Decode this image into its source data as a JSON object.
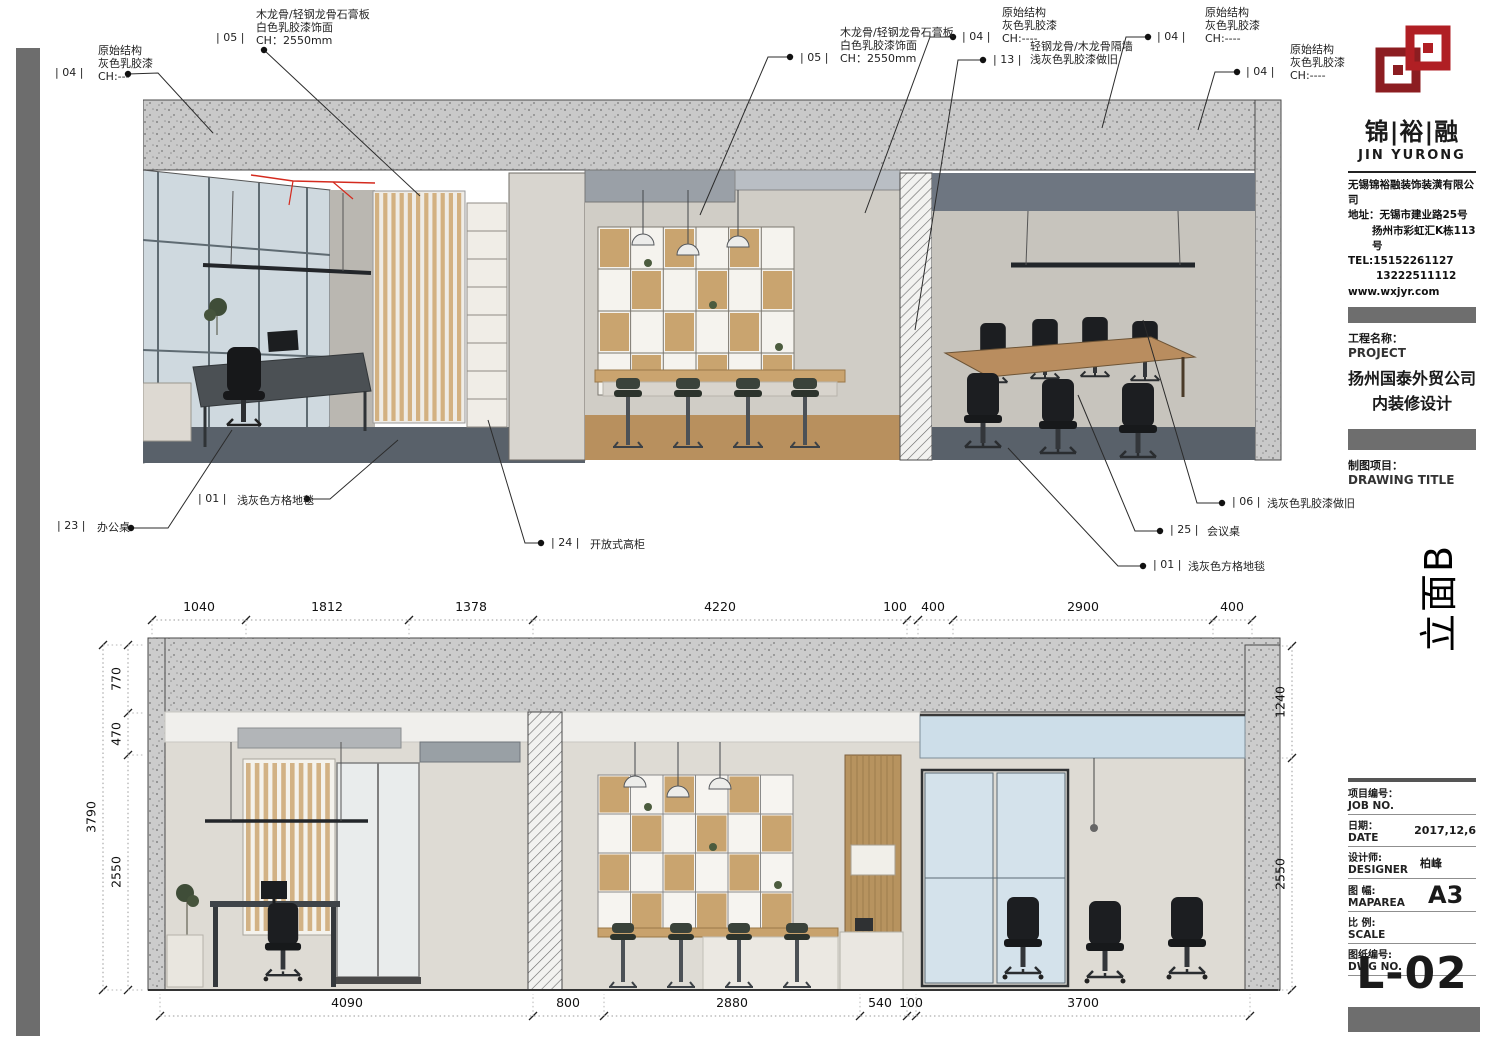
{
  "sidebar": {
    "brand": {
      "cn": "锦|裕|融",
      "en": "JIN YURONG",
      "company": "无锡锦裕融装饰装潢有限公司",
      "addr1": "地址：无锡市建业路25号",
      "addr2": "扬州市彩虹汇K栋113号",
      "tel1": "TEL:15152261127",
      "tel2": "13222511112",
      "web": "www.wxjyr.com",
      "logo_color": "#b01f24"
    },
    "project_label_cn": "工程名称：",
    "project_label_en": "PROJECT",
    "project_name1": "扬州国泰外贸公司",
    "project_name2": "内装修设计",
    "drawing_title_cn": "制图项目：",
    "drawing_title_en": "DRAWING TITLE",
    "elevation_tag": "立面B",
    "fields": [
      {
        "cn": "项目编号：",
        "en": "JOB NO.",
        "value": ""
      },
      {
        "cn": "日期：",
        "en": "DATE",
        "value": "2017,12,6"
      },
      {
        "cn": "设计师:",
        "en": "DESIGNER",
        "value": "柏峰"
      },
      {
        "cn": "图 幅:",
        "en": "MAPAREA",
        "value": "A3",
        "big": true
      },
      {
        "cn": "比 例:",
        "en": "SCALE",
        "value": ""
      },
      {
        "cn": "图纸编号:",
        "en": "DWG NO.",
        "value": ""
      }
    ],
    "dwg_no": "L-02"
  },
  "annotations": [
    {
      "code": "| 04 |",
      "lines": [
        "原始结构",
        "灰色乳胶漆",
        "CH:---"
      ],
      "code_pos": [
        55,
        66
      ],
      "text_pos": [
        98,
        44
      ],
      "leader": [
        [
          128,
          74
        ],
        [
          158,
          73
        ],
        [
          213,
          133
        ]
      ]
    },
    {
      "code": "| 05 |",
      "lines": [
        "木龙骨/轻钢龙骨石膏板",
        "白色乳胶漆饰面",
        "CH：2550mm"
      ],
      "code_pos": [
        216,
        31
      ],
      "text_pos": [
        256,
        8
      ],
      "leader": [
        [
          264,
          50
        ],
        [
          420,
          196
        ]
      ]
    },
    {
      "code": "| 05 |",
      "lines": [
        "木龙骨/轻钢龙骨石膏板",
        "白色乳胶漆饰面",
        "CH：2550mm"
      ],
      "code_pos": [
        800,
        51
      ],
      "text_pos": [
        840,
        26
      ],
      "leader": [
        [
          790,
          57
        ],
        [
          768,
          57
        ],
        [
          700,
          215
        ]
      ]
    },
    {
      "code": "| 04 |",
      "lines": [
        "原始结构",
        "灰色乳胶漆",
        "CH:----"
      ],
      "code_pos": [
        962,
        30
      ],
      "text_pos": [
        1002,
        6
      ],
      "leader": [
        [
          953,
          37
        ],
        [
          930,
          37
        ],
        [
          865,
          213
        ]
      ]
    },
    {
      "code": "| 13 |",
      "lines": [
        "轻钢龙骨/木龙骨隔墙",
        "浅灰色乳胶漆做旧"
      ],
      "code_pos": [
        993,
        53
      ],
      "text_pos": [
        1030,
        40
      ],
      "leader": [
        [
          983,
          60
        ],
        [
          958,
          60
        ],
        [
          915,
          330
        ]
      ]
    },
    {
      "code": "| 04 |",
      "lines": [
        "原始结构",
        "灰色乳胶漆",
        "CH:----"
      ],
      "code_pos": [
        1157,
        30
      ],
      "text_pos": [
        1205,
        6
      ],
      "leader": [
        [
          1148,
          37
        ],
        [
          1126,
          37
        ],
        [
          1102,
          128
        ]
      ]
    },
    {
      "code": "| 04 |",
      "lines": [
        "原始结构",
        "灰色乳胶漆",
        "CH:----"
      ],
      "code_pos": [
        1246,
        65
      ],
      "text_pos": [
        1290,
        43
      ],
      "leader": [
        [
          1237,
          72
        ],
        [
          1215,
          72
        ],
        [
          1198,
          130
        ]
      ]
    }
  ],
  "callouts": [
    {
      "code": "| 23 |",
      "text": "办公桌",
      "code_pos": [
        57,
        519
      ],
      "text_pos": [
        97,
        519
      ],
      "leader": [
        [
          131,
          528
        ],
        [
          168,
          528
        ],
        [
          232,
          430
        ]
      ]
    },
    {
      "code": "| 01 |",
      "text": "浅灰色方格地毯",
      "code_pos": [
        198,
        492
      ],
      "text_pos": [
        237,
        492
      ],
      "leader": [
        [
          307,
          499
        ],
        [
          330,
          499
        ],
        [
          398,
          440
        ]
      ]
    },
    {
      "code": "| 24 |",
      "text": "开放式高柜",
      "code_pos": [
        551,
        536
      ],
      "text_pos": [
        590,
        536
      ],
      "leader": [
        [
          541,
          543
        ],
        [
          525,
          543
        ],
        [
          488,
          420
        ]
      ]
    },
    {
      "code": "| 06 |",
      "text": "浅灰色乳胶漆做旧",
      "code_pos": [
        1232,
        495
      ],
      "text_pos": [
        1267,
        495
      ],
      "leader": [
        [
          1222,
          503
        ],
        [
          1197,
          503
        ],
        [
          1143,
          320
        ]
      ]
    },
    {
      "code": "| 25 |",
      "text": "会议桌",
      "code_pos": [
        1170,
        523
      ],
      "text_pos": [
        1207,
        523
      ],
      "leader": [
        [
          1160,
          531
        ],
        [
          1135,
          531
        ],
        [
          1078,
          395
        ]
      ]
    },
    {
      "code": "| 01 |",
      "text": "浅灰色方格地毯",
      "code_pos": [
        1153,
        558
      ],
      "text_pos": [
        1188,
        558
      ],
      "leader": [
        [
          1143,
          566
        ],
        [
          1118,
          566
        ],
        [
          1008,
          448
        ]
      ]
    }
  ],
  "dims": {
    "h": [
      {
        "y": 620,
        "ly": 614,
        "ext": 18,
        "ticks": [
          152,
          246,
          409,
          533,
          907,
          918,
          953,
          1213,
          1252
        ],
        "labels": [
          {
            "t": "1040",
            "x": 199
          },
          {
            "t": "1812",
            "x": 327
          },
          {
            "t": "1378",
            "x": 471
          },
          {
            "t": "4220",
            "x": 720
          },
          {
            "t": "100",
            "x": 895
          },
          {
            "t": "400",
            "x": 933
          },
          {
            "t": "2900",
            "x": 1083
          },
          {
            "t": "400",
            "x": 1232
          }
        ]
      },
      {
        "y": 1016,
        "ly": 1010,
        "ext": -22,
        "ticks": [
          160,
          533,
          604,
          860,
          907,
          916,
          1250
        ],
        "labels": [
          {
            "t": "4090",
            "x": 347
          },
          {
            "t": "800",
            "x": 568
          },
          {
            "t": "2880",
            "x": 732
          },
          {
            "t": "540",
            "x": 880
          },
          {
            "t": "100",
            "x": 911
          },
          {
            "t": "3700",
            "x": 1083
          }
        ]
      }
    ],
    "v": [
      {
        "x": 103,
        "ext": 20,
        "ticks": [
          645,
          990
        ],
        "labels": [
          {
            "t": "3790",
            "y": 817
          }
        ]
      },
      {
        "x": 128,
        "ext": 16,
        "ticks": [
          645,
          713,
          755,
          990
        ],
        "labels": [
          {
            "t": "770",
            "y": 679
          },
          {
            "t": "470",
            "y": 734
          },
          {
            "t": "2550",
            "y": 872
          }
        ]
      },
      {
        "x": 1292,
        "ext": -14,
        "ticks": [
          646,
          758,
          990
        ],
        "labels": [
          {
            "t": "1240",
            "y": 702
          },
          {
            "t": "2550",
            "y": 874
          }
        ]
      }
    ]
  }
}
